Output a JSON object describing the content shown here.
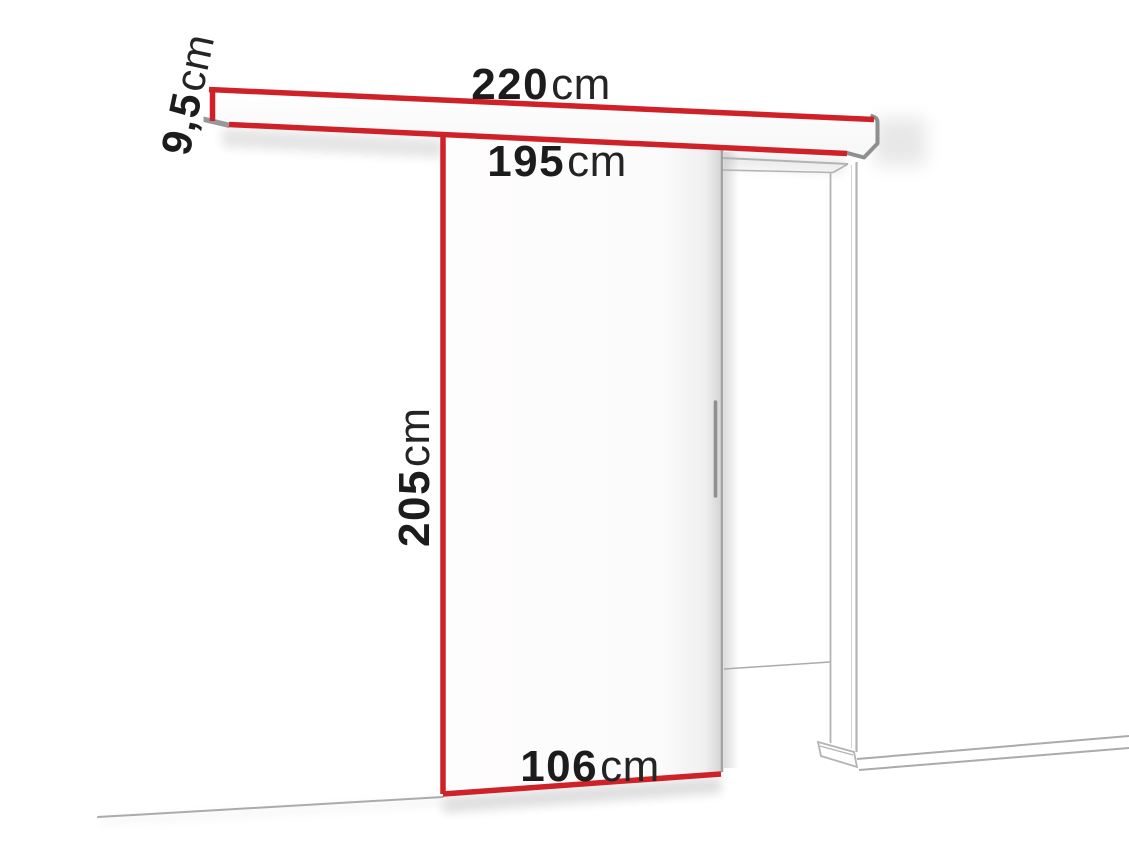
{
  "diagram": {
    "kind": "sliding-door-dimension-drawing",
    "colors": {
      "highlight_red": "#cf2128",
      "cap_gray": "#8d8f91",
      "cap_gray_fill": "#97989a",
      "text": "#1c1c1c",
      "background": "#ffffff"
    },
    "dimensions": {
      "track_width": {
        "value": "220",
        "unit": "cm"
      },
      "track_height": {
        "value": "9,5",
        "unit": "cm"
      },
      "opening_width": {
        "value": "195",
        "unit": "cm"
      },
      "door_height": {
        "value": "205",
        "unit": "cm"
      },
      "door_width": {
        "value": "106",
        "unit": "cm"
      }
    }
  }
}
